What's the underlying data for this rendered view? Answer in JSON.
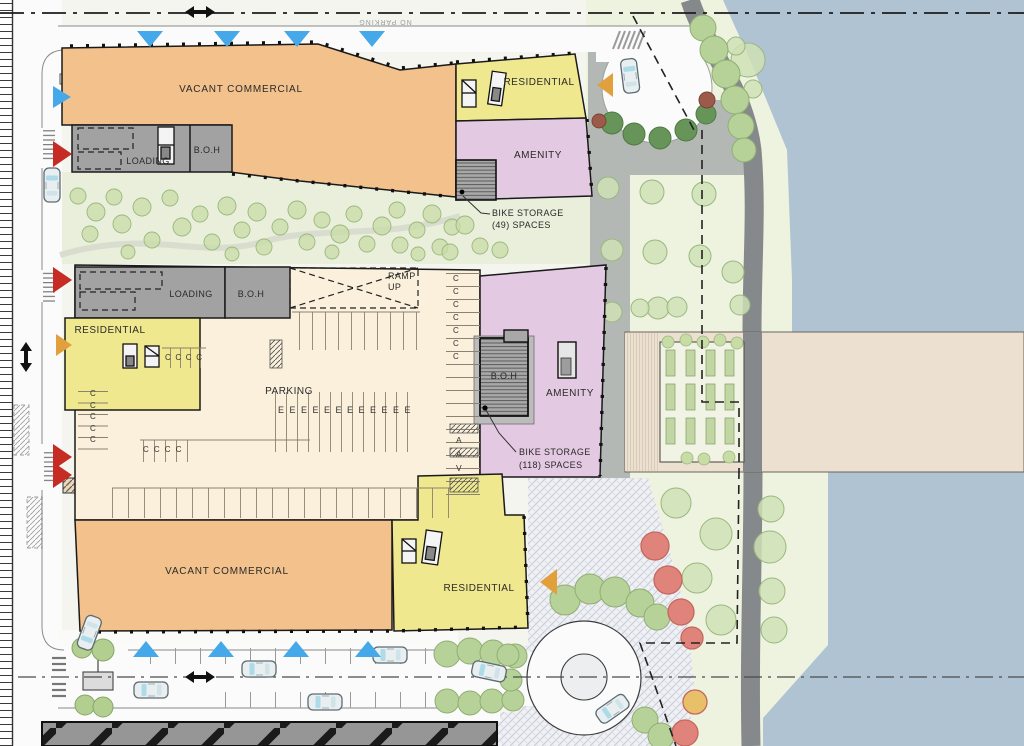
{
  "plan": {
    "title_hint": "waterfront mixed-use site plan",
    "street_note": "NO PARKING",
    "buildings": {
      "commercial_top": "VACANT COMMERCIAL",
      "commercial_bottom": "VACANT COMMERCIAL",
      "residential_top": "RESIDENTIAL",
      "residential_mid": "RESIDENTIAL",
      "residential_bottom": "RESIDENTIAL",
      "amenity_top": "AMENITY",
      "amenity_mid": "AMENITY",
      "loading_top": "LOADING",
      "loading_mid": "LOADING",
      "boh_top": "B.O.H",
      "boh_mid": "B.O.H",
      "boh_core": "B.O.H",
      "parking_label": "PARKING",
      "ramp_label": "RAMP\nUP"
    },
    "annotations": {
      "bike_storage_49": "BIKE STORAGE\n(49) SPACES",
      "bike_storage_118": "BIKE STORAGE\n(118) SPACES"
    },
    "stalls": {
      "c_row_upper": "C C C C",
      "c_col_left": "C\nC\nC\nC\nC",
      "c_row_lower": "C C C C",
      "e_row": "E E E E E E E E E E E E",
      "c_col_right": "C\nC\nC\nC\nC\nC\nC",
      "av_col": "A\nA\nV"
    },
    "colors": {
      "water": "#afc3d3",
      "lawn": "#eef3e0",
      "park": "#e9efda",
      "commercial": "#f3c18c",
      "residential": "#f0e88e",
      "amenity": "#e4c9e2",
      "service_gray": "#a2a2a2",
      "parking_field": "#faf0dc",
      "plaza": "#eff1f5",
      "promenade": "#85898b",
      "pavement": "#b4b8b4",
      "pier": "#ece0d0",
      "tree_green": "#c8dca6",
      "hedge_green": "#b7d298",
      "shrub_dark": "#679459",
      "tree_red": "#e0837b",
      "entry_blue": "#45a9e9",
      "entry_red": "#c62b24",
      "entry_orange": "#e2a03c",
      "existing_building": "#969696"
    }
  }
}
